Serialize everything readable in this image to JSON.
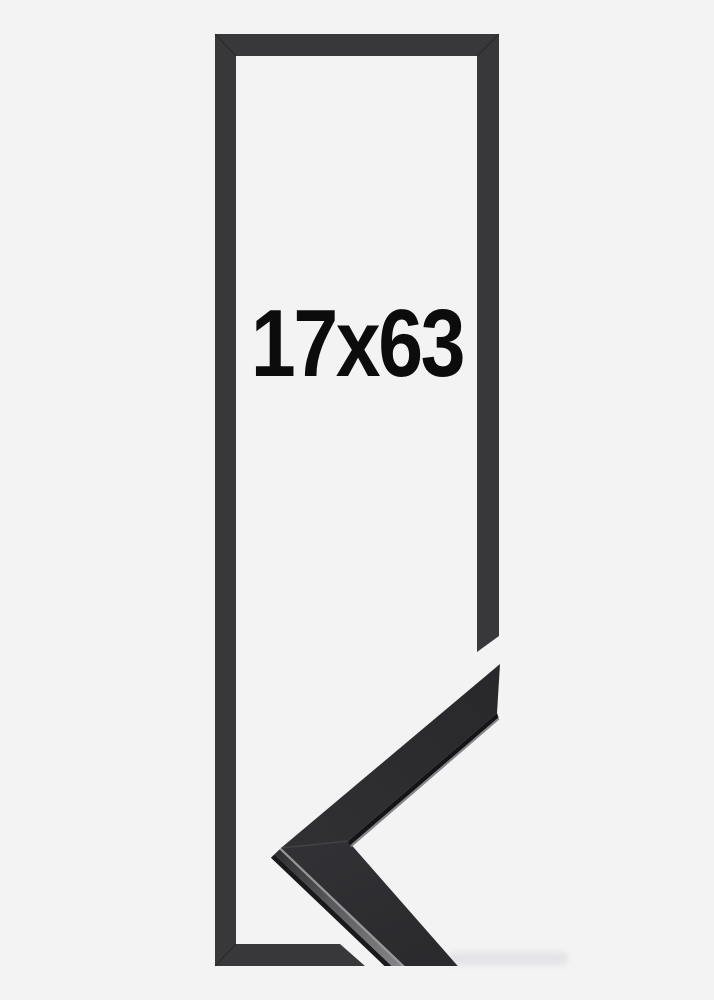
{
  "theme": {
    "background": "#f3f3f4",
    "frame": "#38383b",
    "frame-edge-dark": "#19191c",
    "frame-side-lit": "#858588",
    "label": "#0c0c0c"
  },
  "frame_preview": {
    "size_label": "17x63"
  }
}
